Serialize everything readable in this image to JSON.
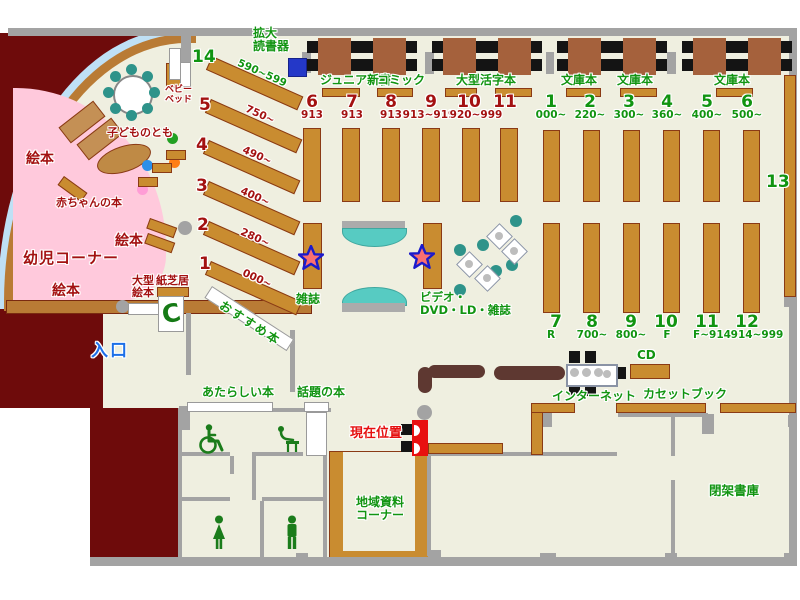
{
  "colors": {
    "floor": "#EFEFE0",
    "dark_red_wall": "#6E0B0B",
    "gray_wall": "#A3A3A3",
    "shelf_brown": "#C98C30",
    "table_brown": "#A5613C",
    "counter_brown": "#5E3831",
    "seat_teal": "#2E938A",
    "bench_teal": "#57CBC2",
    "kids_pink": "#FFC9DC",
    "arc_blue": "#BFE0F5",
    "label_green": "#119411",
    "label_dark_red": "#A31111",
    "label_blue": "#1C6FE8",
    "label_bright_red": "#E51010",
    "magnifier_blue": "#2438C8",
    "marker_red": "#E81010"
  },
  "labels": {
    "magnifier_line1": "拡大",
    "magnifier_line2": "読書器",
    "junior_shinsho": "ジュニア新書",
    "comic": "コミック",
    "large_print": "大型活字本",
    "bunko": "文庫本",
    "magazine": "雑誌",
    "video_line1": "ビデオ・",
    "video_line2": "DVD・LD・雑誌",
    "recommended": "おすすめ本",
    "picture_books": "絵本",
    "baby_books": "赤ちゃんの本",
    "toddler_corner": "幼児コーナー",
    "kodomo_no_tomo": "子どものとも",
    "baby_bed_line1": "ベビー",
    "baby_bed_line2": "ベッド",
    "large_picture_books_line1": "大型",
    "large_picture_books_line2": "絵本",
    "kamishibai": "紙芝居",
    "entrance": "入口",
    "new_books": "あたらしい本",
    "topical_books": "話題の本",
    "current_position": "現在位置",
    "internet": "インターネット",
    "cd": "CD",
    "cassette_book": "カセットブック",
    "local_materials_line1": "地域資料",
    "local_materials_line2": "コーナー",
    "closed_stacks": "閉架書庫",
    "shelf_13": "13"
  },
  "diag_shelves": [
    {
      "num": "14",
      "range": "590~599"
    },
    {
      "num": "5",
      "range": "750~"
    },
    {
      "num": "4",
      "range": "490~"
    },
    {
      "num": "3",
      "range": "400~"
    },
    {
      "num": "2",
      "range": "280~"
    },
    {
      "num": "1",
      "range": "000~"
    }
  ],
  "center_columns": {
    "nums": [
      "6",
      "7",
      "8",
      "9",
      "10",
      "11"
    ],
    "ranges": [
      "913",
      "913",
      "913",
      "913~919",
      "920~999"
    ]
  },
  "right_top_columns": [
    {
      "num": "1",
      "range": "000~"
    },
    {
      "num": "2",
      "range": "220~"
    },
    {
      "num": "3",
      "range": "300~"
    },
    {
      "num": "4",
      "range": "360~"
    },
    {
      "num": "5",
      "range": "400~"
    },
    {
      "num": "6",
      "range": "500~"
    }
  ],
  "right_bottom_columns": [
    {
      "num": "7",
      "range": "R"
    },
    {
      "num": "8",
      "range": "700~"
    },
    {
      "num": "9",
      "range": "800~"
    },
    {
      "num": "10",
      "range": "F"
    },
    {
      "num": "11",
      "range": "F~914"
    },
    {
      "num": "12",
      "range": "914~999"
    }
  ],
  "icons": {
    "wheelchair": "wheelchair-access",
    "baby_changing": "baby-changing-station",
    "woman": "women-restroom",
    "man": "men-restroom",
    "phone": "public-phone",
    "star": "star-marker",
    "current_location": "current-location-marker"
  }
}
